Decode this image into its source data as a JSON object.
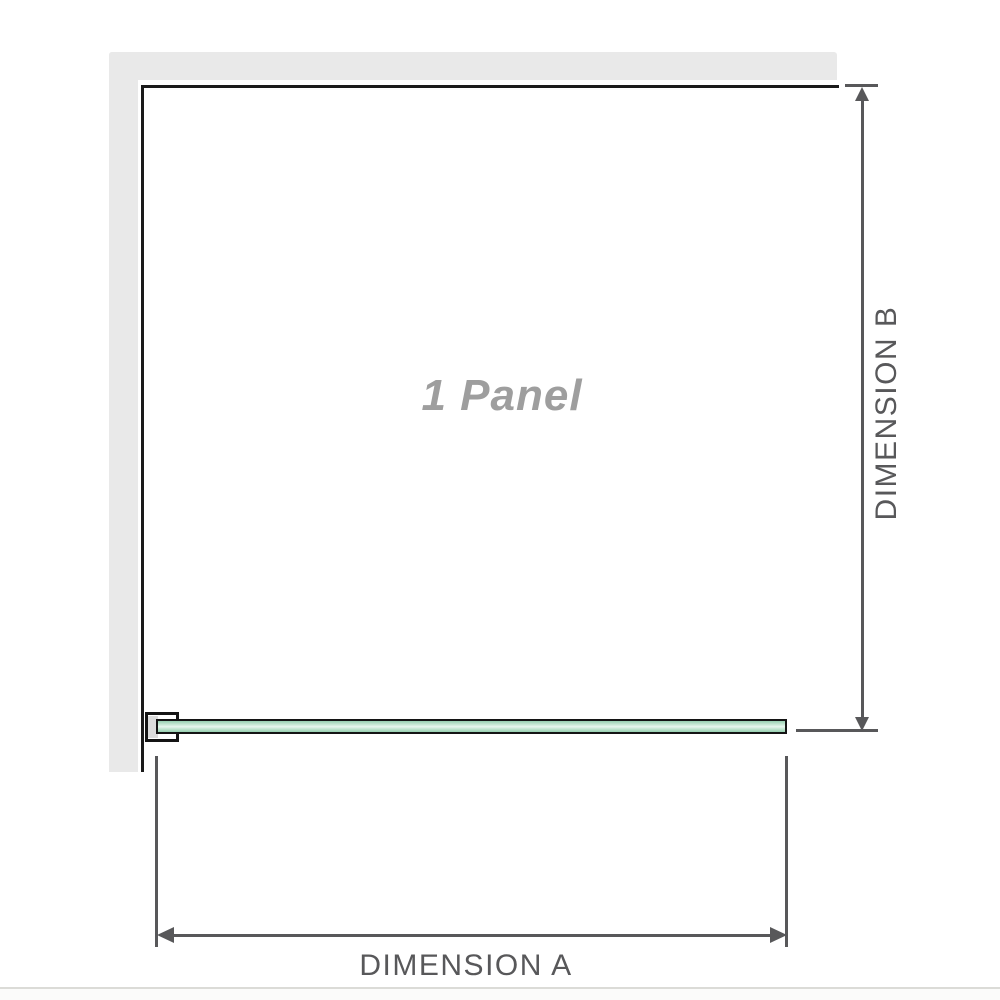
{
  "diagram": {
    "panel_label": "1 Panel",
    "dimension_a_label": "DIMENSION A",
    "dimension_b_label": "DIMENSION B",
    "colors": {
      "wall": "#e9e9e9",
      "frame_line": "#1a1a1a",
      "dimension": "#58585a",
      "panel_label_color": "#9e9e9e",
      "glass_border": "#141414",
      "glass_green": "#96cfb0",
      "glass_green_light": "#e7f6ee",
      "bottom_rule": "#dbdbd7"
    }
  }
}
